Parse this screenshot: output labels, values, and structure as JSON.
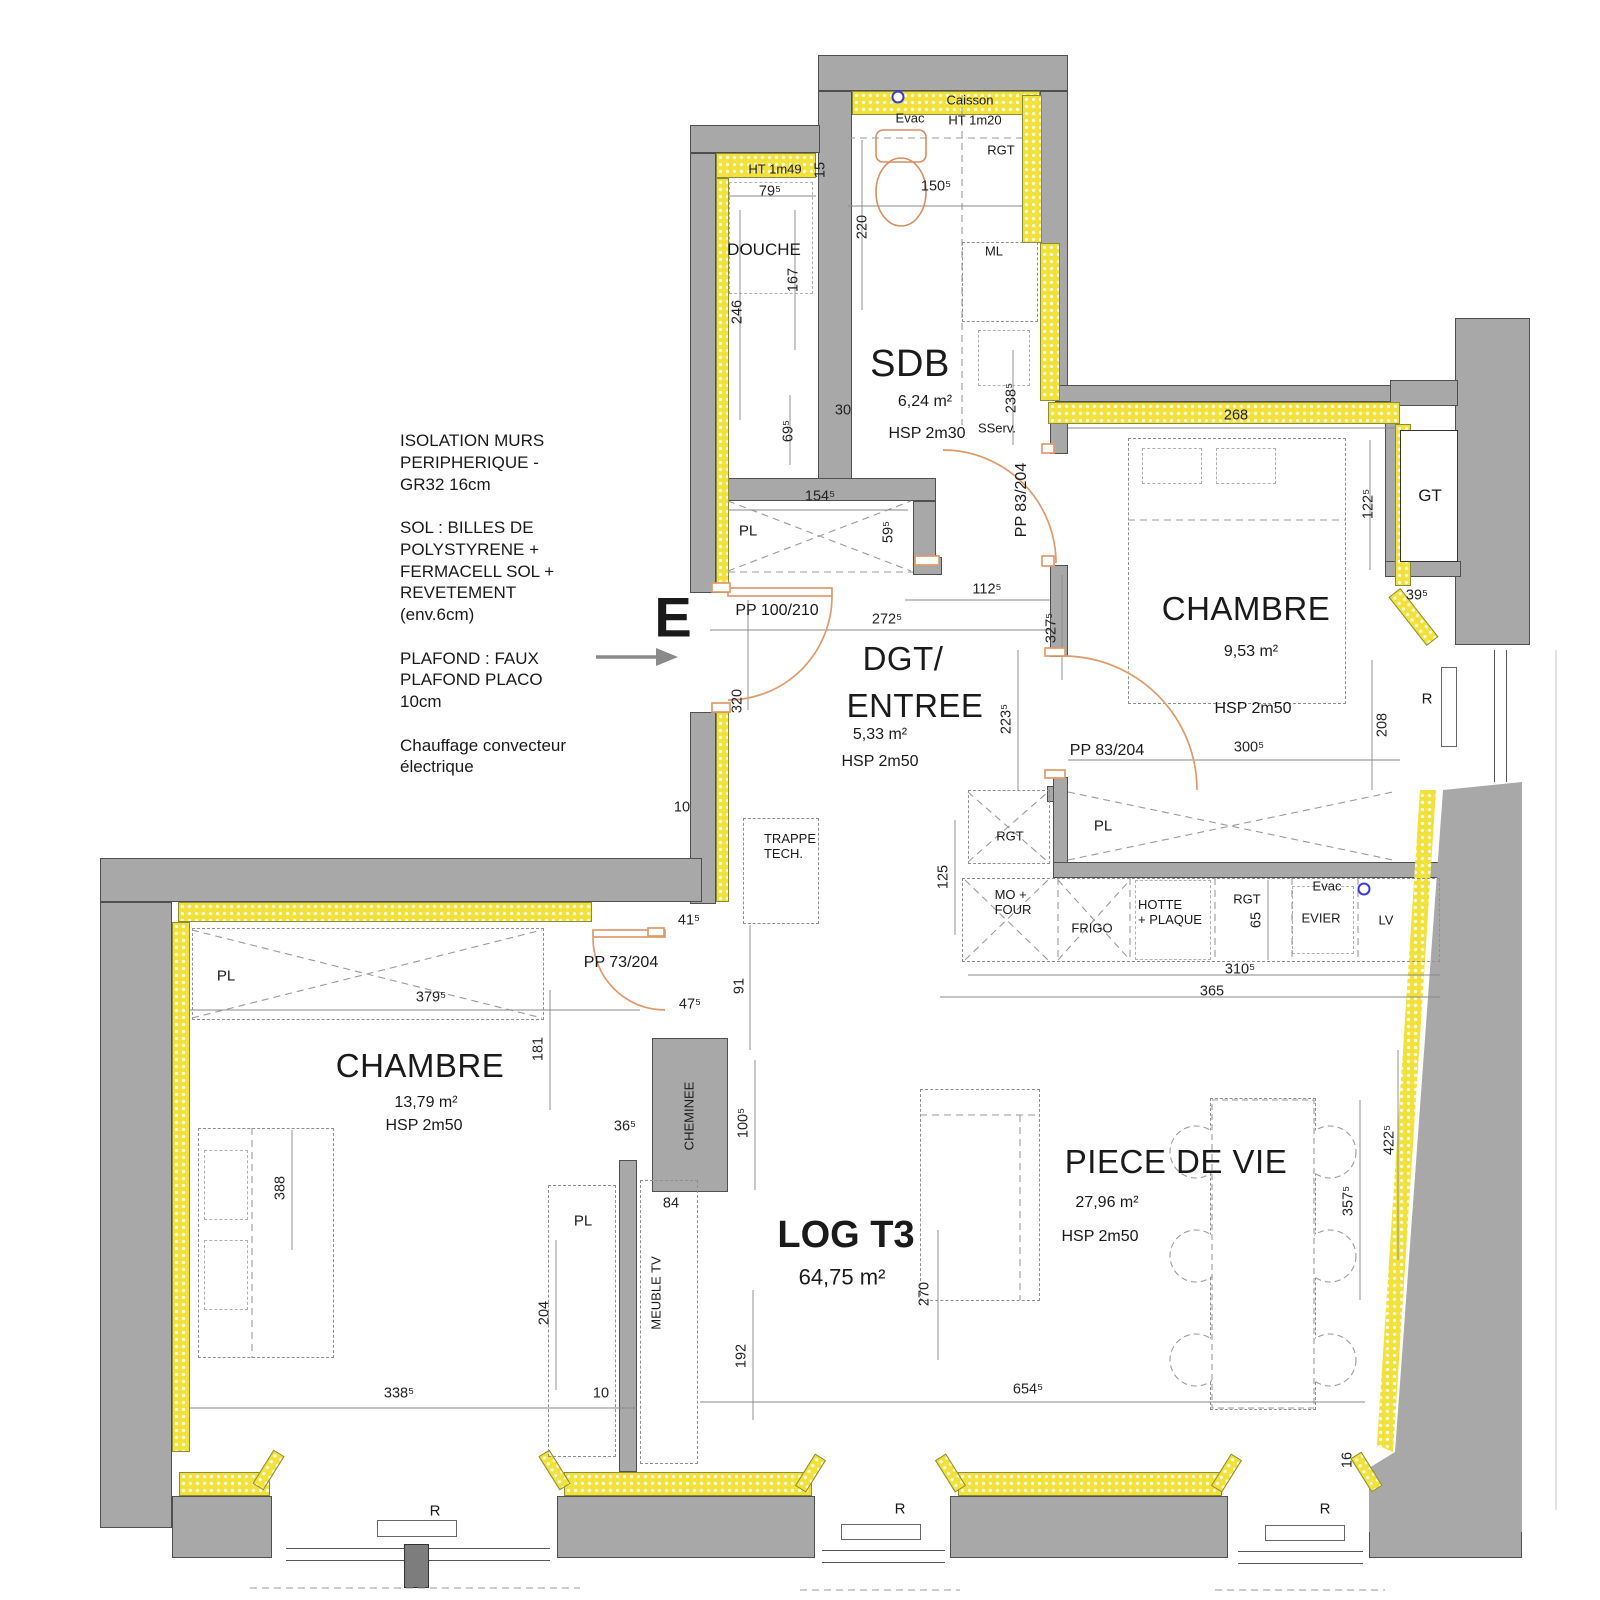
{
  "colors": {
    "wall_gray": "#a8a8a8",
    "insulation_yellow": "#f2e13a",
    "door_orange": "#e09a6a",
    "evac_blue": "#3b3bd4",
    "text": "#1a1a1a"
  },
  "notes": {
    "block": "ISOLATION MURS\nPERIPHERIQUE -\nGR32 16cm\n\nSOL : BILLES DE\nPOLYSTYRENE +\nFERMACELL SOL +\nREVETEMENT\n(env.6cm)\n\nPLAFOND : FAUX\nPLAFOND PLACO\n10cm\n\nChauffage convecteur\nélectrique"
  },
  "entrance": {
    "marker": "E"
  },
  "rooms": {
    "sdb": {
      "name": "SDB",
      "area": "6,24 m²",
      "height": "HSP 2m30"
    },
    "douche": {
      "name": "DOUCHE",
      "note": "HT 1m49"
    },
    "dgt": {
      "name_line1": "DGT/",
      "name_line2": "ENTREE",
      "area": "5,33 m²",
      "height": "HSP 2m50"
    },
    "chambre_est": {
      "name": "CHAMBRE",
      "area": "9,53 m²",
      "height": "HSP 2m50"
    },
    "chambre_ouest": {
      "name": "CHAMBRE",
      "area": "13,79 m²",
      "height": "HSP 2m50"
    },
    "piece_de_vie": {
      "name": "PIECE DE VIE",
      "area": "27,96 m²",
      "height": "HSP 2m50"
    },
    "logement": {
      "name": "LOG T3",
      "area": "64,75 m²"
    }
  },
  "features": {
    "caisson": "Caisson",
    "caisson_ht": "HT 1m20",
    "evac_sdb": "Evac",
    "rgt_sdb": "RGT",
    "ml": "ML",
    "sserv": "SServ.",
    "gt": "GT",
    "trappe": "TRAPPE\nTECH.",
    "cheminee": "CHEMINEE",
    "meuble_tv": "MEUBLE TV",
    "placard": "PL",
    "radiateur": "R",
    "kitchen": {
      "mo_four": "MO +\nFOUR",
      "frigo": "FRIGO",
      "hotte": "HOTTE\n+ PLAQUE",
      "rgt_colonne": "RGT",
      "rgt_plan": "RGT",
      "evier": "EVIER",
      "lv": "LV",
      "evac": "Evac"
    }
  },
  "doors": {
    "entree": "PP 100/210",
    "sserv": "PP 83/204",
    "chambre_est": "PP 83/204",
    "chambre_ouest": "PP 73/204"
  },
  "dims": {
    "d79_5": "79⁵",
    "d15": "15",
    "d150_5": "150⁵",
    "d220": "220",
    "d167": "167",
    "d246": "246",
    "d30": "30",
    "d69_5": "69⁵",
    "d238_5": "238⁵",
    "d268": "268",
    "d122_5": "122⁵",
    "d39_5": "39⁵",
    "d154_5": "154⁵",
    "d59_5": "59⁵",
    "d112_5": "112⁵",
    "d272_5": "272⁵",
    "d320": "320",
    "d327_5": "327⁵",
    "d223_5": "223⁵",
    "d300_5": "300⁵",
    "d208": "208",
    "d10_dgt": "10",
    "d41_5": "41⁵",
    "d91": "91",
    "d47_5": "47⁵",
    "d36_5": "36⁵",
    "d84": "84",
    "d100_5": "100⁵",
    "d181": "181",
    "d379_5": "379⁵",
    "d388": "388",
    "d204": "204",
    "d338_5": "338⁵",
    "d10_bas": "10",
    "d192": "192",
    "d270": "270",
    "d654_5": "654⁵",
    "d125": "125",
    "d65": "65",
    "d310_5": "310⁵",
    "d365": "365",
    "d357_5": "357⁵",
    "d422_5": "422⁵",
    "d16": "16"
  }
}
